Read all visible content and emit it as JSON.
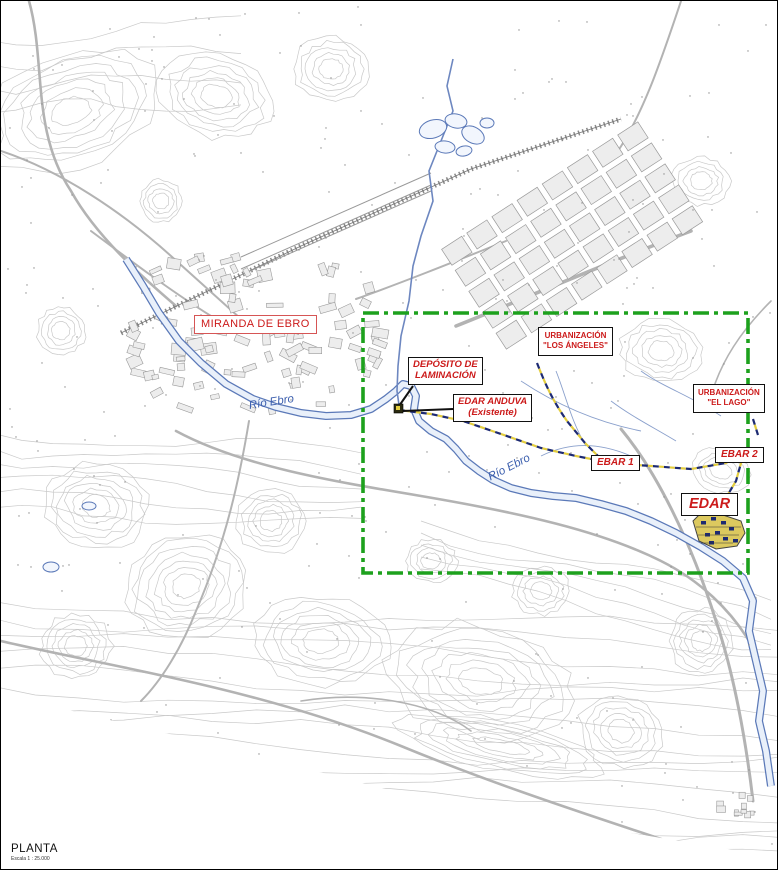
{
  "titleblock": {
    "name": "PLANTA",
    "scale": "Escala 1 : 25.000"
  },
  "labels": {
    "city": "MIRANDA DE EBRO",
    "deposito_line1": "DEPÓSITO DE",
    "deposito_line2": "LAMINACIÓN",
    "edar_anduva_line1": "EDAR ANDUVA",
    "edar_anduva_line2": "(Existente)",
    "urb_los_angeles_line1": "URBANIZACIÓN",
    "urb_los_angeles_line2": "\"LOS ÁNGELES\"",
    "urb_el_lago_line1": "URBANIZACIÓN",
    "urb_el_lago_line2": "\"EL LAGO\"",
    "ebar1": "EBAR 1",
    "ebar2": "EBAR 2",
    "edar": "EDAR",
    "river_label_1": "Río Ebro",
    "river_label_2": "Río Ebro"
  },
  "colors": {
    "label_red": "#cc1a1a",
    "river_blue": "#5b79b8",
    "river_fill": "#e9f0fa",
    "stream_blue": "#6d87c0",
    "canal_blue": "#8aa0cc",
    "study_area_green": "#1da11d",
    "pipeline_navy": "#1d2a72",
    "pipeline_yellow": "#e3cd3e",
    "contour_gray": "#c9c9c9",
    "contour_gray2": "#bdbdbd",
    "road_gray": "#b3b3b3",
    "rail_gray": "#8a8a8a",
    "block_fill": "#ededed",
    "block_stroke": "#9a9a9a",
    "dot_gray": "#8d8d8d",
    "facility_yellow": "#dcc95f",
    "leader_black": "#111111"
  }
}
